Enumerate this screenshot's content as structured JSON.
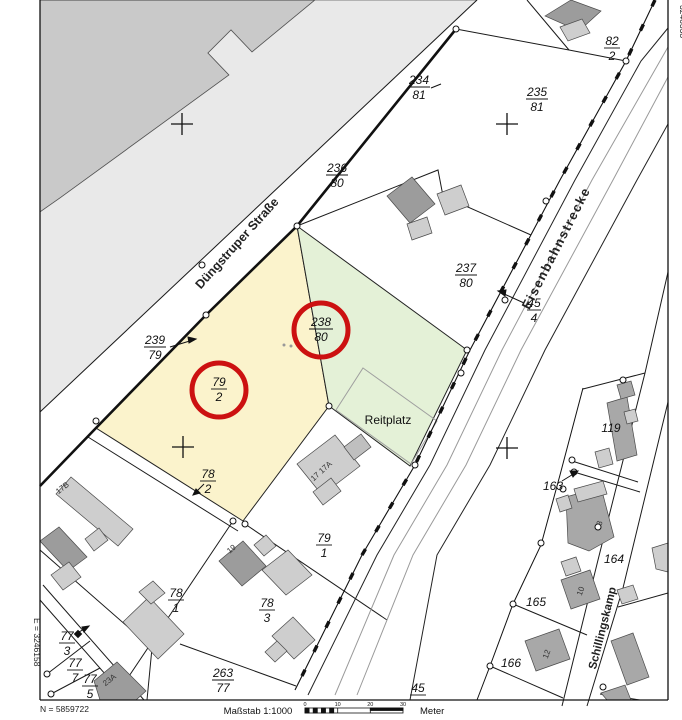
{
  "margin": {
    "east_left": "E = 3246158",
    "east_right": "3246338",
    "north_label": "N = 5859722",
    "scale_label": "Maßstab 1:1000",
    "scale_unit": "Meter",
    "scale_ticks": [
      "0",
      "10",
      "20",
      "30"
    ]
  },
  "streets": {
    "duengstruper": "Düngstruper Straße",
    "eisenbahn": "Eisenbahnstrecke",
    "schillingskamp": "Schillingskamp",
    "reitplatz": "Reitplatz"
  },
  "parcels": {
    "p234": {
      "num": "234",
      "den": "81"
    },
    "p235": {
      "num": "235",
      "den": "81"
    },
    "p82": {
      "num": "82",
      "den": "2"
    },
    "p236": {
      "num": "236",
      "den": "80"
    },
    "p237": {
      "num": "237",
      "den": "80"
    },
    "p238": {
      "num": "238",
      "den": "80"
    },
    "p239": {
      "num": "239",
      "den": "79"
    },
    "p79_2": {
      "num": "79",
      "den": "2"
    },
    "p78_2": {
      "num": "78",
      "den": "2"
    },
    "p78_1": {
      "num": "78",
      "den": "1"
    },
    "p79_1": {
      "num": "79",
      "den": "1"
    },
    "p78_3": {
      "num": "78",
      "den": "3"
    },
    "p263": {
      "num": "263",
      "den": "77"
    },
    "p77_3": {
      "num": "77",
      "den": "3"
    },
    "p77_7": {
      "num": "77",
      "den": "7"
    },
    "p77_5": {
      "num": "77",
      "den": "5"
    },
    "p45_4": {
      "num": "45",
      "den": "4"
    },
    "p45": {
      "num": "45"
    },
    "p119": "119",
    "p163": "163",
    "p164": "164",
    "p165": "165",
    "p166": "166"
  },
  "house_numbers": {
    "h17b": "17B",
    "h17": "17  17A",
    "h19": "19",
    "h23a": "23A",
    "h8": "8",
    "h10": "10",
    "h12": "12"
  },
  "colors": {
    "highlight_red": "#cc1111",
    "parcel_yellow": "#fbf3cc",
    "parcel_green": "#e4f1d7",
    "area_gray": "#c9c9c9",
    "strip_gray": "#e9e9e9"
  }
}
